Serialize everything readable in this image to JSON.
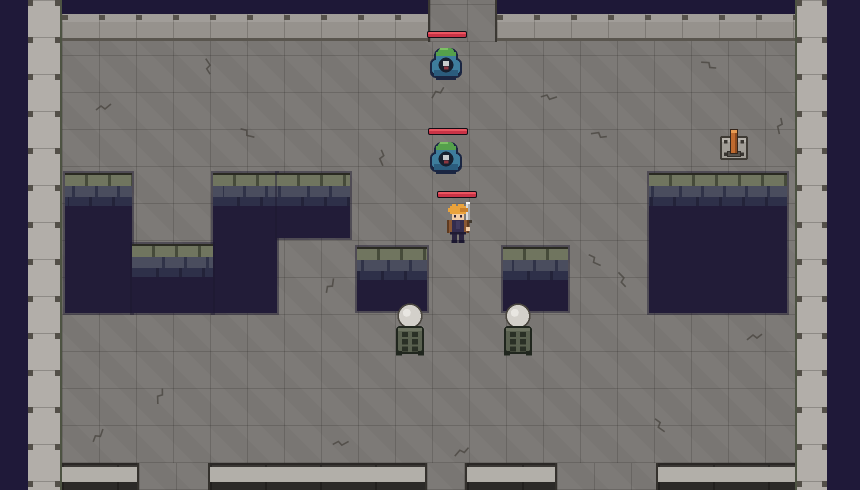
{
  "scene": {
    "description": "top-down pixel-art dungeon room with enemies and hazards",
    "colors": {
      "void_outside": "#1f1939",
      "floor": "#7b7875",
      "wall": "#b2aea9",
      "pit": "#221c38",
      "pit_brick_green": "#70755f",
      "pit_brick_blue": "#4a4d5e",
      "health_bar_red": "#d23c4c",
      "slime_body": "#3e7d9c",
      "slime_cap_green": "#55a04b",
      "hero_hair": "#eaa33c",
      "lever_handle": "#c06a2e"
    }
  },
  "level": {
    "outside": {
      "left_w": 28,
      "right_x": 827,
      "top_h": 14
    },
    "wall_left": {
      "x": 28,
      "w": 34
    },
    "wall_right": {
      "x": 795,
      "w": 32
    },
    "top_band": {
      "y": 14,
      "h": 27
    },
    "floor": {
      "x": 62,
      "y": 41,
      "w": 733,
      "h": 422
    },
    "top_exit": {
      "x": 428,
      "w": 69
    },
    "top_void_strips": [
      [
        62,
        366
      ],
      [
        497,
        298
      ]
    ],
    "bottom_wall": {
      "y": 463,
      "h": 27,
      "segments": [
        [
          62,
          75
        ],
        [
          210,
          215
        ],
        [
          467,
          88
        ],
        [
          658,
          137
        ]
      ]
    },
    "bottom_exits": [
      [
        137,
        73
      ],
      [
        425,
        42
      ],
      [
        555,
        103
      ]
    ],
    "pits": [
      {
        "x": 65,
        "y": 173,
        "w": 67,
        "h": 140
      },
      {
        "x": 213,
        "y": 173,
        "w": 64,
        "h": 140
      },
      {
        "x": 277,
        "y": 173,
        "w": 73,
        "h": 65
      },
      {
        "x": 132,
        "y": 244,
        "w": 81,
        "h": 69
      },
      {
        "x": 649,
        "y": 173,
        "w": 138,
        "h": 140
      },
      {
        "x": 357,
        "y": 247,
        "w": 70,
        "h": 64
      },
      {
        "x": 503,
        "y": 247,
        "w": 65,
        "h": 64
      }
    ]
  },
  "entities": {
    "enemies": [
      {
        "type": "slime",
        "x": 428,
        "y": 44,
        "hp_pct": 100,
        "bar": {
          "x": 427,
          "y": 31
        }
      },
      {
        "type": "slime",
        "x": 428,
        "y": 138,
        "hp_pct": 100,
        "bar": {
          "x": 428,
          "y": 128
        }
      }
    ],
    "player": {
      "type": "hero",
      "x": 442,
      "y": 202,
      "hp_pct": 100,
      "bar": {
        "x": 437,
        "y": 191
      }
    },
    "objects": [
      {
        "type": "lever",
        "x": 716,
        "y": 128
      },
      {
        "type": "brazier",
        "x": 392,
        "y": 302
      },
      {
        "type": "brazier",
        "x": 500,
        "y": 302
      }
    ]
  }
}
